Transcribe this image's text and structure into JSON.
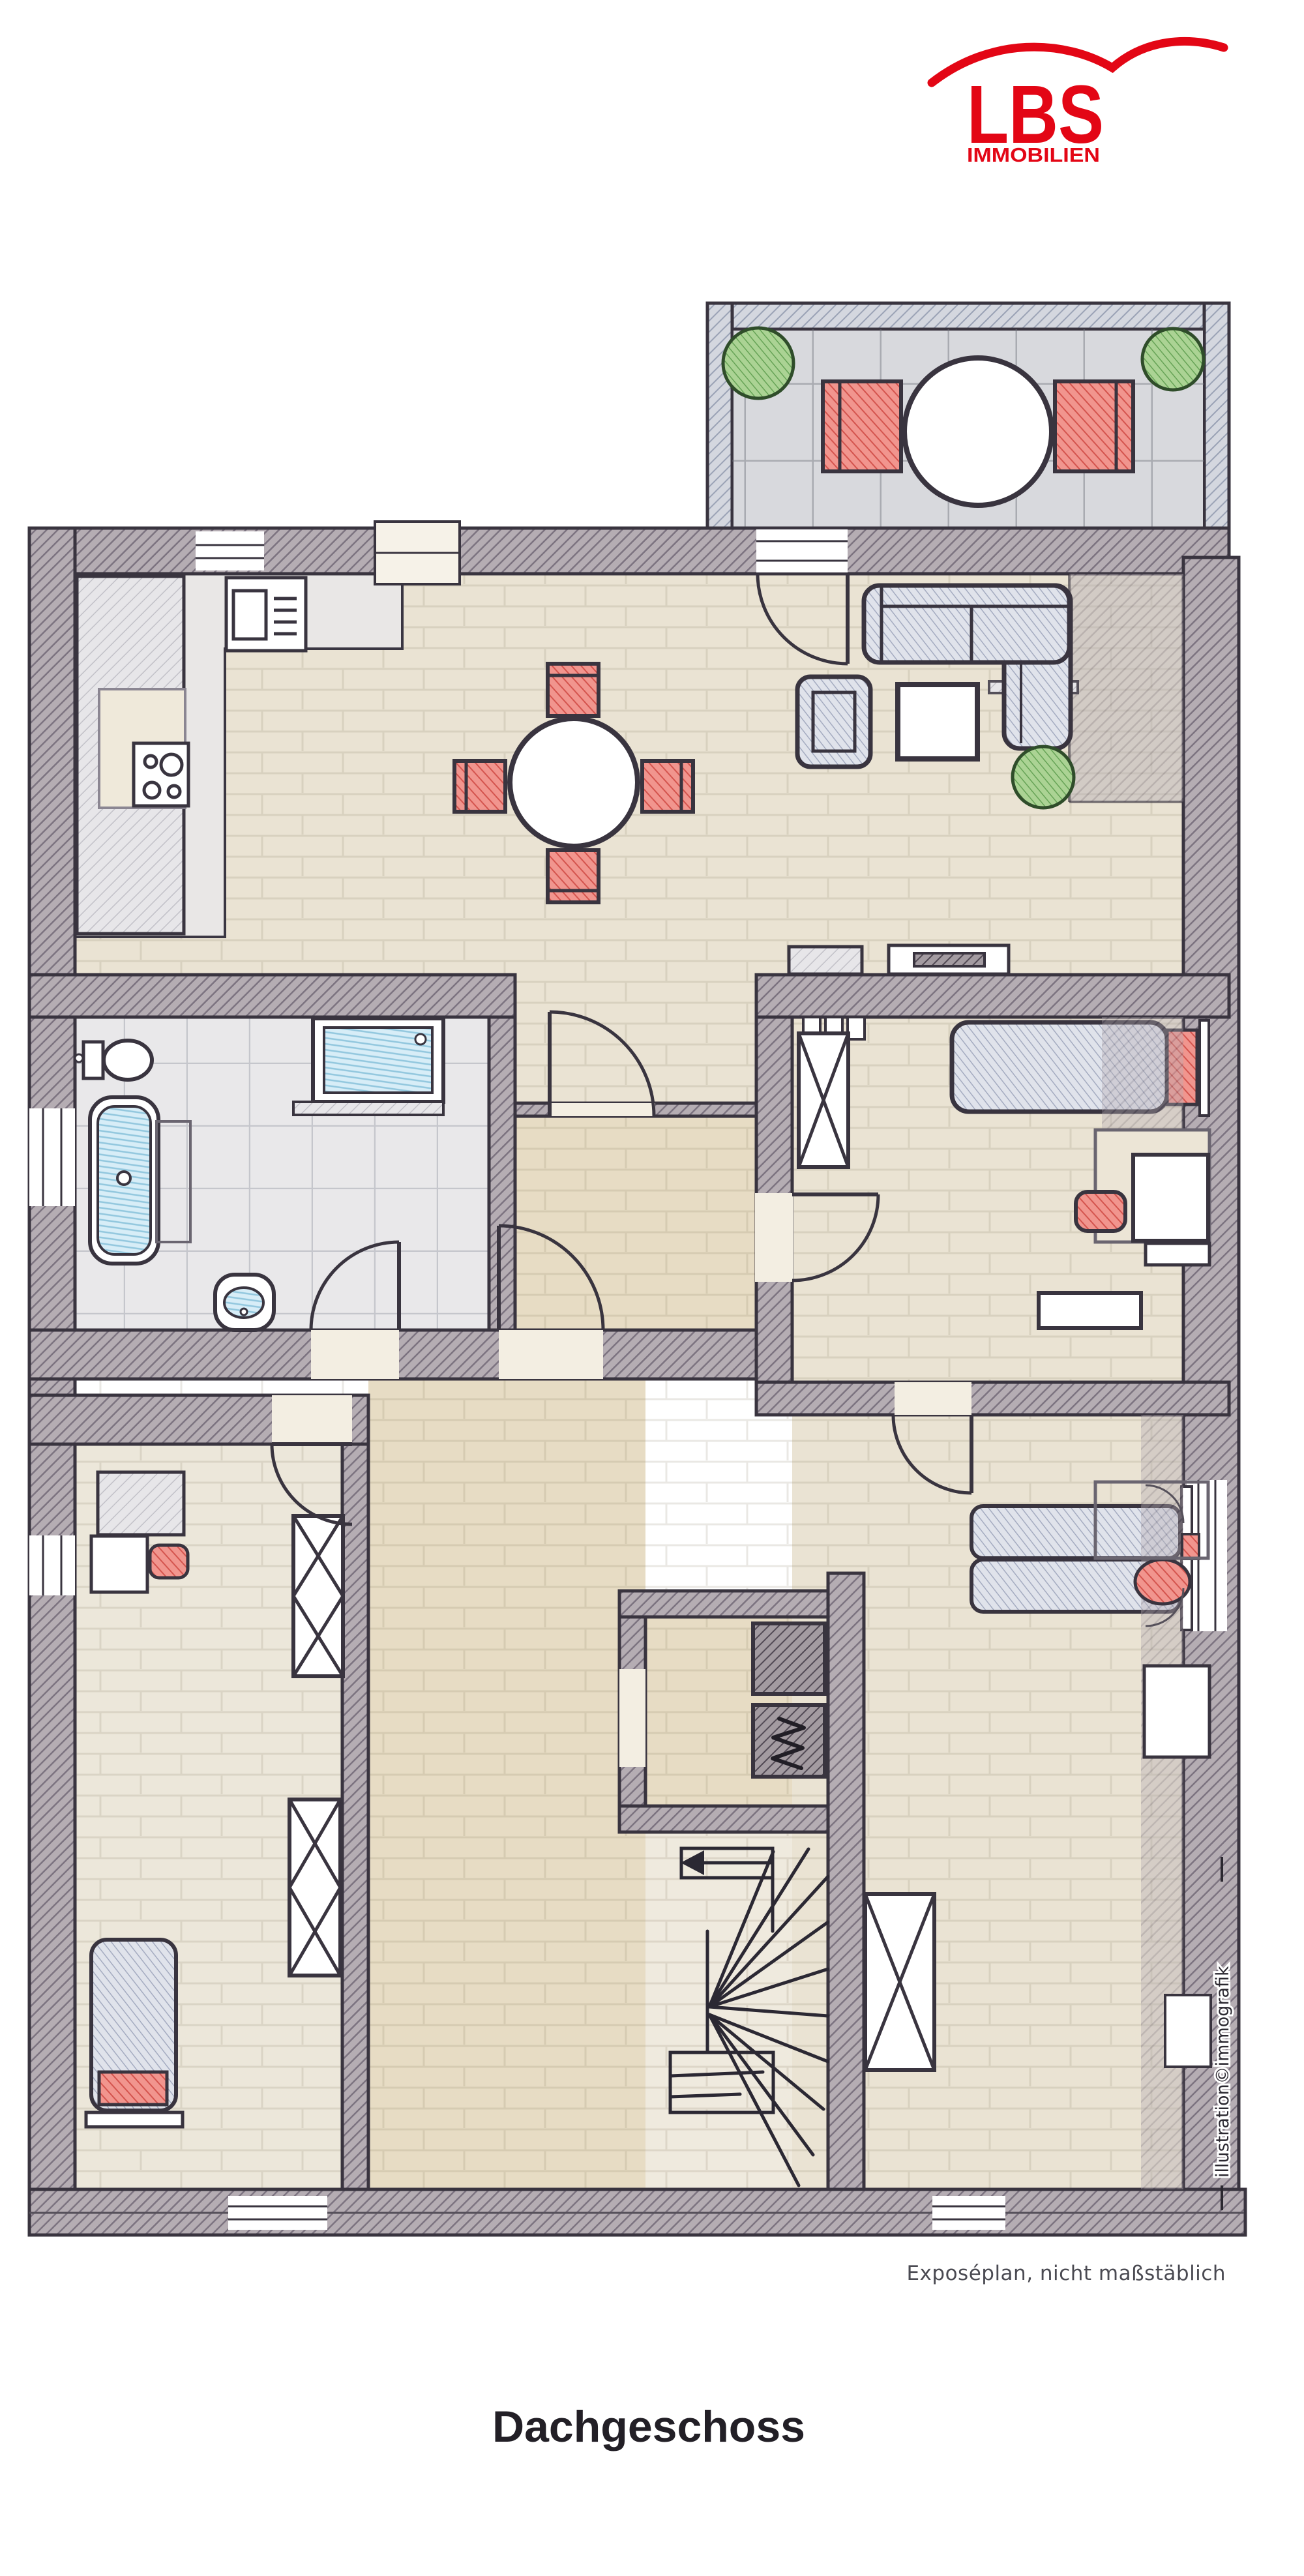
{
  "logo": {
    "text": "LBS",
    "subtext": "IMMOBILIEN",
    "color": "#e30615"
  },
  "plan": {
    "disclaimer": "Exposéplan, nicht maßstäblich",
    "credit": "illustration©immografik",
    "colors": {
      "wall_gray": "#b5adb3",
      "balcony_wall": "#d4d7df",
      "accent_red": "#f1958e",
      "plant_green": "#abd394",
      "water_blue": "#d7edf7",
      "floor_beige": "#eae3d3",
      "floor_hall": "#e7dcc4",
      "bath_floor": "#e9e8ea",
      "outline": "#39343f"
    }
  },
  "footer": {
    "title": "Dachgeschoss"
  }
}
